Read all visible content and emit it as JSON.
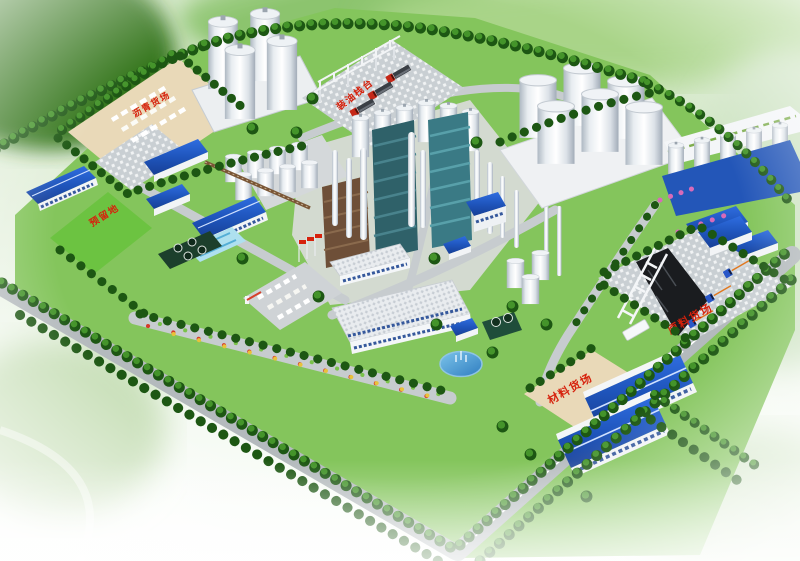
{
  "labels": {
    "asphalt_yard": "沥青货场",
    "reserved_land": "预留地",
    "oil_loading_rack": "装油栈台",
    "raw_material_yard": "原料货场",
    "material_yard": "材料货场"
  },
  "scene": {
    "large_silos_topleft": 4,
    "big_storage_tanks_right": 6,
    "red_trucks_at_loading_rack": 3,
    "blue_tanker_trucks_raw_yard": 3
  },
  "colors": {
    "label_red": "#d6210c",
    "roof_blue": "#2460c8",
    "campus_green": "#83c45c",
    "tree_green": "#1d5713",
    "pavement_gray": "#ccd1d5",
    "yard_tan": "#e9d9b8",
    "tank_white": "#f4f6f8",
    "coal_black": "#1a1c1f",
    "water_blue": "#4f9fd8"
  }
}
